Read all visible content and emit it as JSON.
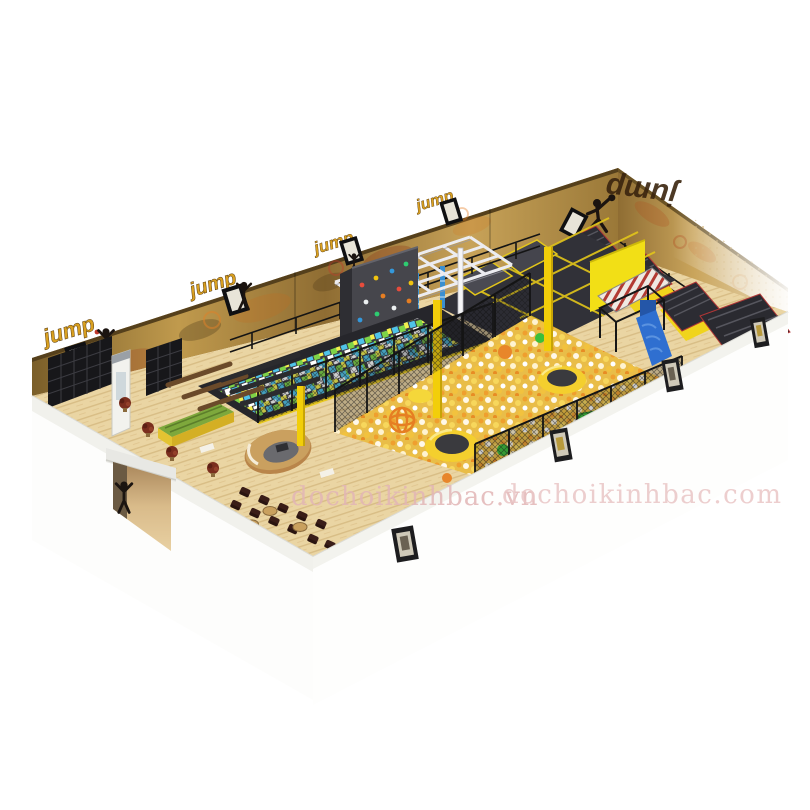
{
  "image_type": "3d cutaway render of an indoor trampoline park",
  "watermark": {
    "left": "dochoikinhbac.vn",
    "right": "dochoikinhbac.com",
    "color": "#e2b6b6"
  },
  "branding": {
    "jump_label": "jump",
    "sign_color": "#d9a020",
    "sign_accent": "#c0392b"
  },
  "colors": {
    "background": "#ffffff",
    "wall_gold": "#b8903f",
    "wall_dark": "#6e5524",
    "accent_yellow": "#f2d40a",
    "trampoline_dark": "#33333a",
    "ball_pit_gold": "#e9bd48",
    "foam_blue": "#4fc3e8",
    "foam_green": "#7ed348",
    "foam_yellow": "#f3ef4e",
    "wood_floor": "#ead5a3",
    "exterior_white": "#fdfdfc",
    "slide_blue": "#2f6fd0",
    "plastic_green": "#3bbf3b",
    "orange": "#e8862a"
  },
  "scene_elements": [
    "jump-wall-sign",
    "jumping-person-silhouette",
    "dunking-person-silhouette",
    "shoe-cubbies",
    "vending-machine",
    "benches",
    "reception-desk",
    "cafe-seating",
    "potted-plants",
    "foam-cube-pit",
    "climbing-wall",
    "ninja-frame-course",
    "trampoline-court",
    "incline-trampolines",
    "striped-runway",
    "ball-pit",
    "round-trampolines",
    "ball-pit-slide",
    "plastic-ladder",
    "mesh-fences",
    "safety-poles",
    "entrance-door",
    "framed-pictures",
    "watermark"
  ]
}
